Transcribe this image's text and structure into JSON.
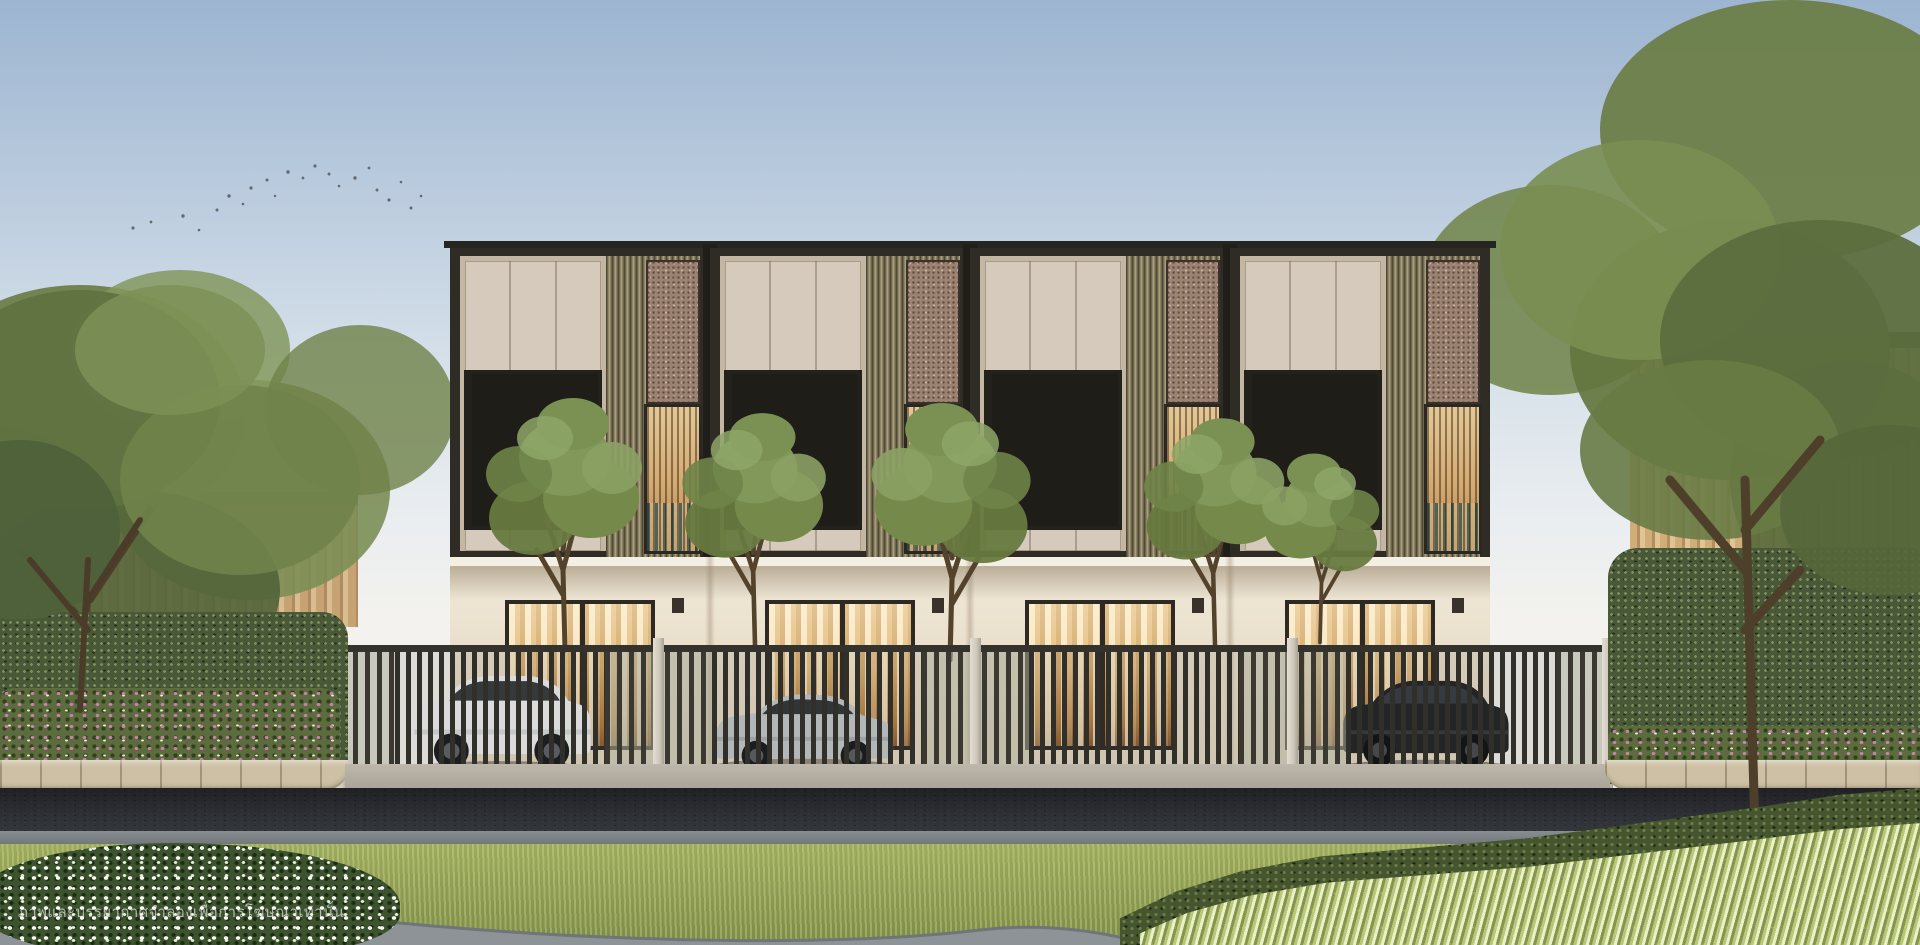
{
  "disclaimer": {
    "text": "ภาพและบรรยากาศจำลองเพื่อการโฆษณาเท่านั้น"
  },
  "scene": {
    "subject": "two-storey-modern-townhouse-row",
    "townhouse_units_visible": 4,
    "cars_visible": 3,
    "car_colors": [
      "#eef0f1",
      "#c2c7ca",
      "#1d2023"
    ],
    "birds_in_flock": 22,
    "palette": {
      "sky_top": "#9db5d2",
      "sky_horizon": "#f3f2ee",
      "frame_dark": "#2b2a23",
      "panel_beige": "#d5cabc",
      "ground_floor_cream": "#e9dfcb",
      "slat_bronze": "#8e8569",
      "terrazzo": "#9c8273",
      "window_glow": "#ecc68d",
      "fence_dark": "#3a3831",
      "fence_post_light": "#dcd7cb",
      "hedge_green": "#4a583a",
      "flower_pink": "#cd7fb1",
      "road_asphalt": "#33363c",
      "curb_beige": "#cdc0a4",
      "grass_green": "#93a355",
      "variegated_leaf": "#f2f8ce"
    }
  }
}
